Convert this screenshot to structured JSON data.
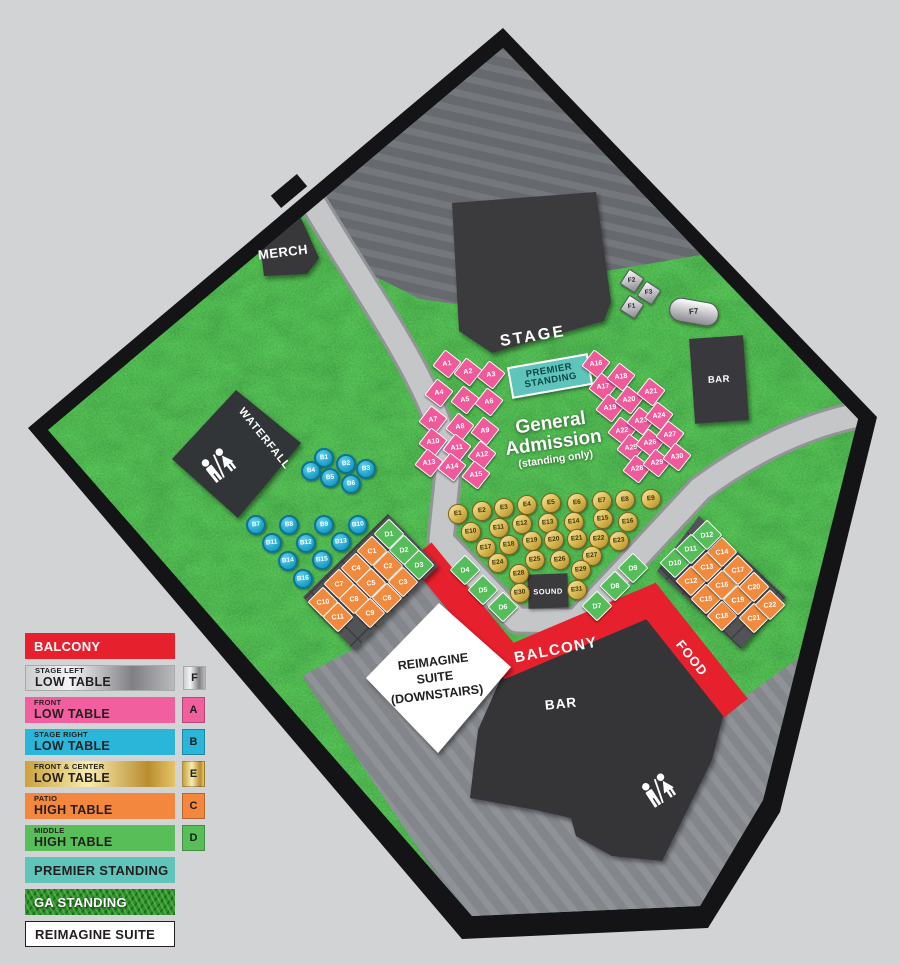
{
  "map": {
    "labels": {
      "stage": "STAGE",
      "merch": "MERCH",
      "waterfall": "WATERFALL",
      "bar_top": "BAR",
      "bar_bottom": "BAR",
      "food": "FOOD",
      "balcony": "BALCONY",
      "sound": "SOUND",
      "premier_line1": "PREMIER",
      "premier_line2": "STANDING",
      "ga_line1": "General",
      "ga_line2": "Admission",
      "ga_line3": "(standing only)",
      "suite_line1": "REIMAGINE",
      "suite_line2": "SUITE",
      "suite_line3": "(DOWNSTAIRS)"
    },
    "tables": {
      "groups": [
        {
          "id": "A",
          "name": "front-low-table",
          "shape": "square",
          "color": "#f0599a",
          "rot": 38,
          "seats": [
            [
              "A1",
              447,
              364
            ],
            [
              "A2",
              468,
              372
            ],
            [
              "A3",
              491,
              375
            ],
            [
              "A4",
              439,
              393
            ],
            [
              "A5",
              465,
              400
            ],
            [
              "A6",
              489,
              402
            ],
            [
              "A7",
              433,
              420
            ],
            [
              "A8",
              460,
              427
            ],
            [
              "A9",
              485,
              431
            ],
            [
              "A10",
              433,
              442
            ],
            [
              "A11",
              457,
              448
            ],
            [
              "A12",
              482,
              455
            ],
            [
              "A13",
              429,
              463
            ],
            [
              "A14",
              452,
              467
            ],
            [
              "A15",
              476,
              475
            ],
            [
              "A16",
              596,
              364
            ],
            [
              "A17",
              603,
              387
            ],
            [
              "A18",
              621,
              377
            ],
            [
              "A19",
              610,
              408
            ],
            [
              "A20",
              629,
              400
            ],
            [
              "A21",
              651,
              392
            ],
            [
              "A22",
              622,
              431
            ],
            [
              "A23",
              641,
              421
            ],
            [
              "A24",
              659,
              416
            ],
            [
              "A25",
              631,
              448
            ],
            [
              "A26",
              650,
              443
            ],
            [
              "A27",
              670,
              435
            ],
            [
              "A28",
              637,
              469
            ],
            [
              "A29",
              657,
              463
            ],
            [
              "A30",
              677,
              457
            ]
          ]
        },
        {
          "id": "B",
          "name": "stage-right-low-table",
          "shape": "circle",
          "color": "#29b6d8",
          "rot": 0,
          "seats": [
            [
              "B1",
              324,
              458
            ],
            [
              "B2",
              346,
              464
            ],
            [
              "B3",
              366,
              469
            ],
            [
              "B4",
              311,
              471
            ],
            [
              "B5",
              330,
              478
            ],
            [
              "B6",
              351,
              484
            ],
            [
              "B7",
              256,
              525
            ],
            [
              "B8",
              289,
              525
            ],
            [
              "B9",
              324,
              525
            ],
            [
              "B10",
              358,
              525
            ],
            [
              "B11",
              272,
              543
            ],
            [
              "B12",
              306,
              543
            ],
            [
              "B13",
              341,
              542
            ],
            [
              "B14",
              288,
              561
            ],
            [
              "B15",
              322,
              560
            ],
            [
              "B16",
              303,
              579
            ]
          ]
        },
        {
          "id": "C",
          "name": "patio-high-table",
          "shape": "diamond",
          "color": "#f4873e",
          "rot": 45,
          "seats": [
            [
              "C1",
              372,
              551
            ],
            [
              "C2",
              388,
              566
            ],
            [
              "C3",
              403,
              582
            ],
            [
              "C4",
              356,
              568
            ],
            [
              "C5",
              371,
              583
            ],
            [
              "C6",
              387,
              598
            ],
            [
              "C7",
              339,
              584
            ],
            [
              "C8",
              354,
              599
            ],
            [
              "C9",
              370,
              613
            ],
            [
              "C10",
              323,
              602
            ],
            [
              "C11",
              338,
              617
            ],
            [
              "C12",
              691,
              581
            ],
            [
              "C13",
              707,
              567
            ],
            [
              "C14",
              722,
              552
            ],
            [
              "C15",
              706,
              599
            ],
            [
              "C16",
              722,
              585
            ],
            [
              "C17",
              738,
              570
            ],
            [
              "C18",
              722,
              616
            ],
            [
              "C19",
              738,
              600
            ],
            [
              "C20",
              754,
              587
            ],
            [
              "C21",
              754,
              618
            ],
            [
              "C22",
              770,
              605
            ]
          ]
        },
        {
          "id": "D",
          "name": "middle-high-table",
          "shape": "diamond",
          "color": "#57be58",
          "rot": 45,
          "seats": [
            [
              "D1",
              389,
              534
            ],
            [
              "D2",
              404,
              550
            ],
            [
              "D3",
              419,
              565
            ],
            [
              "D4",
              465,
              570
            ],
            [
              "D5",
              483,
              590
            ],
            [
              "D6",
              503,
              607
            ],
            [
              "D7",
              597,
              606
            ],
            [
              "D8",
              615,
              586
            ],
            [
              "D9",
              633,
              568
            ],
            [
              "D10",
              675,
              563
            ],
            [
              "D11",
              691,
              549
            ],
            [
              "D12",
              707,
              535
            ]
          ]
        },
        {
          "id": "E",
          "name": "front-center-low-table",
          "shape": "circle",
          "color": "#d9b84f",
          "rot": 0,
          "seats": [
            [
              "E1",
              458,
              514
            ],
            [
              "E2",
              482,
              511
            ],
            [
              "E3",
              504,
              508
            ],
            [
              "E4",
              527,
              505
            ],
            [
              "E5",
              551,
              503
            ],
            [
              "E6",
              577,
              503
            ],
            [
              "E7",
              602,
              501
            ],
            [
              "E8",
              625,
              500
            ],
            [
              "E9",
              651,
              499
            ],
            [
              "E10",
              471,
              532
            ],
            [
              "E11",
              499,
              528
            ],
            [
              "E12",
              522,
              524
            ],
            [
              "E13",
              548,
              523
            ],
            [
              "E14",
              574,
              522
            ],
            [
              "E15",
              603,
              519
            ],
            [
              "E16",
              628,
              522
            ],
            [
              "E17",
              486,
              548
            ],
            [
              "E18",
              509,
              545
            ],
            [
              "E19",
              532,
              541
            ],
            [
              "E20",
              554,
              540
            ],
            [
              "E21",
              577,
              539
            ],
            [
              "E22",
              599,
              539
            ],
            [
              "E23",
              619,
              541
            ],
            [
              "E24",
              498,
              563
            ],
            [
              "E25",
              535,
              560
            ],
            [
              "E26",
              560,
              560
            ],
            [
              "E27",
              592,
              556
            ],
            [
              "E28",
              519,
              574
            ],
            [
              "E29",
              581,
              570
            ],
            [
              "E30",
              520,
              593
            ],
            [
              "E31",
              577,
              590
            ]
          ]
        },
        {
          "id": "F",
          "name": "stage-left-low-table",
          "shape": "square",
          "color": "#c7c7cb",
          "rot": 33,
          "seats": [
            [
              "F1",
              632,
              307
            ],
            [
              "F2",
              632,
              281
            ],
            [
              "F3",
              649,
              293
            ]
          ]
        },
        {
          "id": "F7",
          "name": "stage-left-low-table-large",
          "shape": "pill",
          "color": "#c7c7cb",
          "rot": 10,
          "seats": [
            [
              "F7",
              694,
              312
            ]
          ]
        }
      ]
    }
  },
  "legend": {
    "items": [
      {
        "label": "BALCONY",
        "style": "red",
        "color": "#e7202d"
      },
      {
        "top": "STAGE LEFT",
        "bottom": "LOW TABLE",
        "style": "silver",
        "badge": "F",
        "color": "#c0c0c4"
      },
      {
        "top": "FRONT",
        "bottom": "LOW TABLE",
        "style": "pink",
        "badge": "A",
        "color": "#f25f9e"
      },
      {
        "top": "STAGE RIGHT",
        "bottom": "LOW TABLE",
        "style": "cyan",
        "badge": "B",
        "color": "#29b6d8"
      },
      {
        "top": "FRONT & CENTER",
        "bottom": "LOW TABLE",
        "style": "gold",
        "badge": "E",
        "color": "#d9b84f"
      },
      {
        "top": "PATIO",
        "bottom": "HIGH TABLE",
        "style": "orange",
        "badge": "C",
        "color": "#f4873e"
      },
      {
        "top": "MIDDLE",
        "bottom": "HIGH TABLE",
        "style": "green",
        "badge": "D",
        "color": "#57be58"
      },
      {
        "label": "PREMIER STANDING",
        "style": "teal",
        "color": "#5fc5ba"
      },
      {
        "label": "GA STANDING",
        "style": "grass",
        "color": "#2e8f2e"
      },
      {
        "label": "REIMAGINE SUITE",
        "style": "white",
        "color": "#ffffff"
      }
    ]
  },
  "colors": {
    "background": "#d2d3d5",
    "frame": "#141417",
    "grass": "#2f8c33",
    "walkway": "#c5c6c8",
    "balcony_red": "#e7202d",
    "structure_dark": "#3b3b3e"
  }
}
